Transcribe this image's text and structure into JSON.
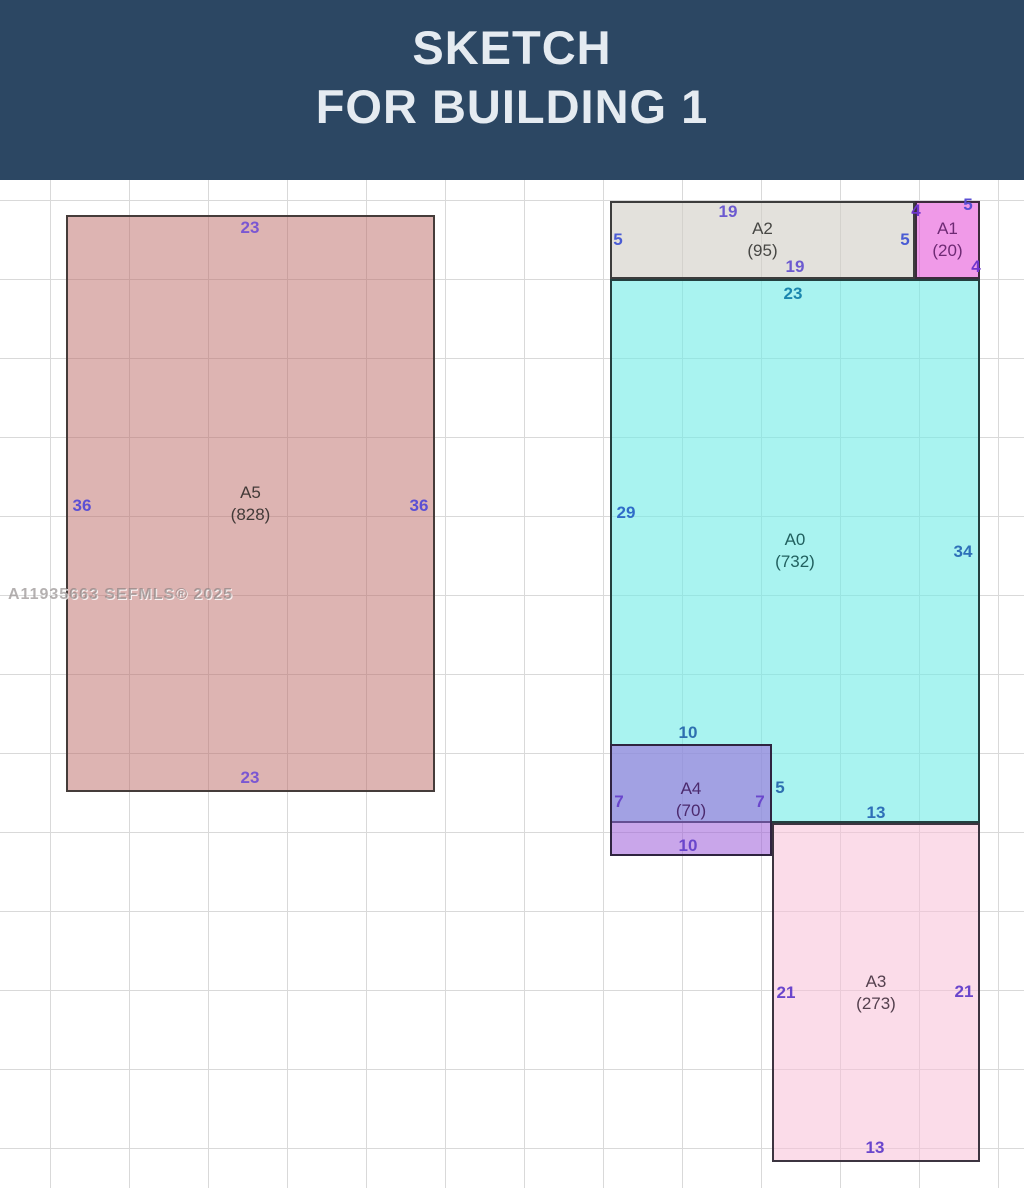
{
  "header": {
    "title_line1": "SKETCH",
    "title_line2": "FOR BUILDING 1",
    "bg_color": "#2c4763",
    "text_color": "#e5ebf1"
  },
  "watermark": {
    "text": "A11935663  SEFMLS® 2025"
  },
  "grid": {
    "spacing_x": 79,
    "spacing_y": 79,
    "offset_x": 50,
    "offset_y": 20,
    "line_color": "#d9d9d9"
  },
  "canvas_top": 180,
  "areas": [
    {
      "id": "A5",
      "name": "A5",
      "value": "(828)",
      "x": 66,
      "y": 215,
      "w": 369,
      "h": 577,
      "fill": "rgba(187,106,102,0.5)",
      "border": "#453c3a",
      "label_color": "#433a38"
    },
    {
      "id": "A2",
      "name": "A2",
      "value": "(95)",
      "x": 610,
      "y": 201,
      "w": 305,
      "h": 78,
      "fill": "rgba(208,205,196,0.6)",
      "border": "#3c3c3c",
      "label_color": "#474744"
    },
    {
      "id": "A1",
      "name": "A1",
      "value": "(20)",
      "x": 915,
      "y": 201,
      "w": 65,
      "h": 78,
      "fill": "rgba(230,87,217,0.6)",
      "border": "#3c2a3c",
      "label_color": "#6e2a74"
    },
    {
      "id": "A0",
      "name": "A0",
      "value": "(732)",
      "x": 610,
      "y": 279,
      "w": 370,
      "h": 544,
      "fill": "rgba(112,235,230,0.6)",
      "border": "#233f3f",
      "label_color": "#21605f"
    },
    {
      "id": "A4",
      "name": "A4",
      "value": "(70)",
      "x": 610,
      "y": 744,
      "w": 162,
      "h": 112,
      "fill": "rgba(156,93,216,0.55)",
      "border": "#2f2440",
      "label_color": "#4c2a6e"
    },
    {
      "id": "A3",
      "name": "A3",
      "value": "(273)",
      "x": 772,
      "y": 823,
      "w": 208,
      "h": 339,
      "fill": "rgba(247,191,215,0.55)",
      "border": "#3c3440",
      "label_color": "#54404e"
    }
  ],
  "dimension_labels": [
    {
      "text": "23",
      "x": 250,
      "y": 228,
      "color": "#7b57d2",
      "side": "a5-top"
    },
    {
      "text": "36",
      "x": 82,
      "y": 506,
      "color": "#5b4fd4",
      "side": "a5-left"
    },
    {
      "text": "36",
      "x": 419,
      "y": 506,
      "color": "#5b4fd4",
      "side": "a5-right"
    },
    {
      "text": "23",
      "x": 250,
      "y": 778,
      "color": "#7b57d2",
      "side": "a5-bottom"
    },
    {
      "text": "19",
      "x": 728,
      "y": 212,
      "color": "#6c5ad0",
      "side": "a2-top"
    },
    {
      "text": "5",
      "x": 618,
      "y": 240,
      "color": "#4a5cd4",
      "side": "a2-left"
    },
    {
      "text": "19",
      "x": 795,
      "y": 267,
      "color": "#6c5ad0",
      "side": "a2-bottom"
    },
    {
      "text": "5",
      "x": 905,
      "y": 240,
      "color": "#4a5cd4",
      "side": "a2-right"
    },
    {
      "text": "4",
      "x": 916,
      "y": 211,
      "color": "#6f35cc",
      "side": "a1-top-left"
    },
    {
      "text": "5",
      "x": 968,
      "y": 205,
      "color": "#5b4fd4",
      "side": "a1-top-right"
    },
    {
      "text": "4",
      "x": 976,
      "y": 267,
      "color": "#6f35cc",
      "side": "a1-bottom-right"
    },
    {
      "text": "23",
      "x": 793,
      "y": 294,
      "color": "#1a86ae",
      "side": "a0-top"
    },
    {
      "text": "29",
      "x": 626,
      "y": 513,
      "color": "#2f6cc8",
      "side": "a0-left"
    },
    {
      "text": "34",
      "x": 963,
      "y": 552,
      "color": "#2e70b8",
      "side": "a0-right"
    },
    {
      "text": "10",
      "x": 688,
      "y": 733,
      "color": "#2e6fb0",
      "side": "a4-top-outside"
    },
    {
      "text": "5",
      "x": 780,
      "y": 788,
      "color": "#2e6fb0",
      "side": "a4-right-outside"
    },
    {
      "text": "13",
      "x": 876,
      "y": 813,
      "color": "#2e70b8",
      "side": "a0-bottom"
    },
    {
      "text": "7",
      "x": 619,
      "y": 802,
      "color": "#6a46cc",
      "side": "a4-left"
    },
    {
      "text": "7",
      "x": 760,
      "y": 802,
      "color": "#6a46cc",
      "side": "a4-right"
    },
    {
      "text": "10",
      "x": 688,
      "y": 846,
      "color": "#6a46cc",
      "side": "a4-bottom"
    },
    {
      "text": "21",
      "x": 786,
      "y": 993,
      "color": "#6a46cc",
      "side": "a3-left"
    },
    {
      "text": "21",
      "x": 964,
      "y": 992,
      "color": "#6a46cc",
      "side": "a3-right"
    },
    {
      "text": "13",
      "x": 875,
      "y": 1148,
      "color": "#6a46cc",
      "side": "a3-bottom"
    }
  ]
}
